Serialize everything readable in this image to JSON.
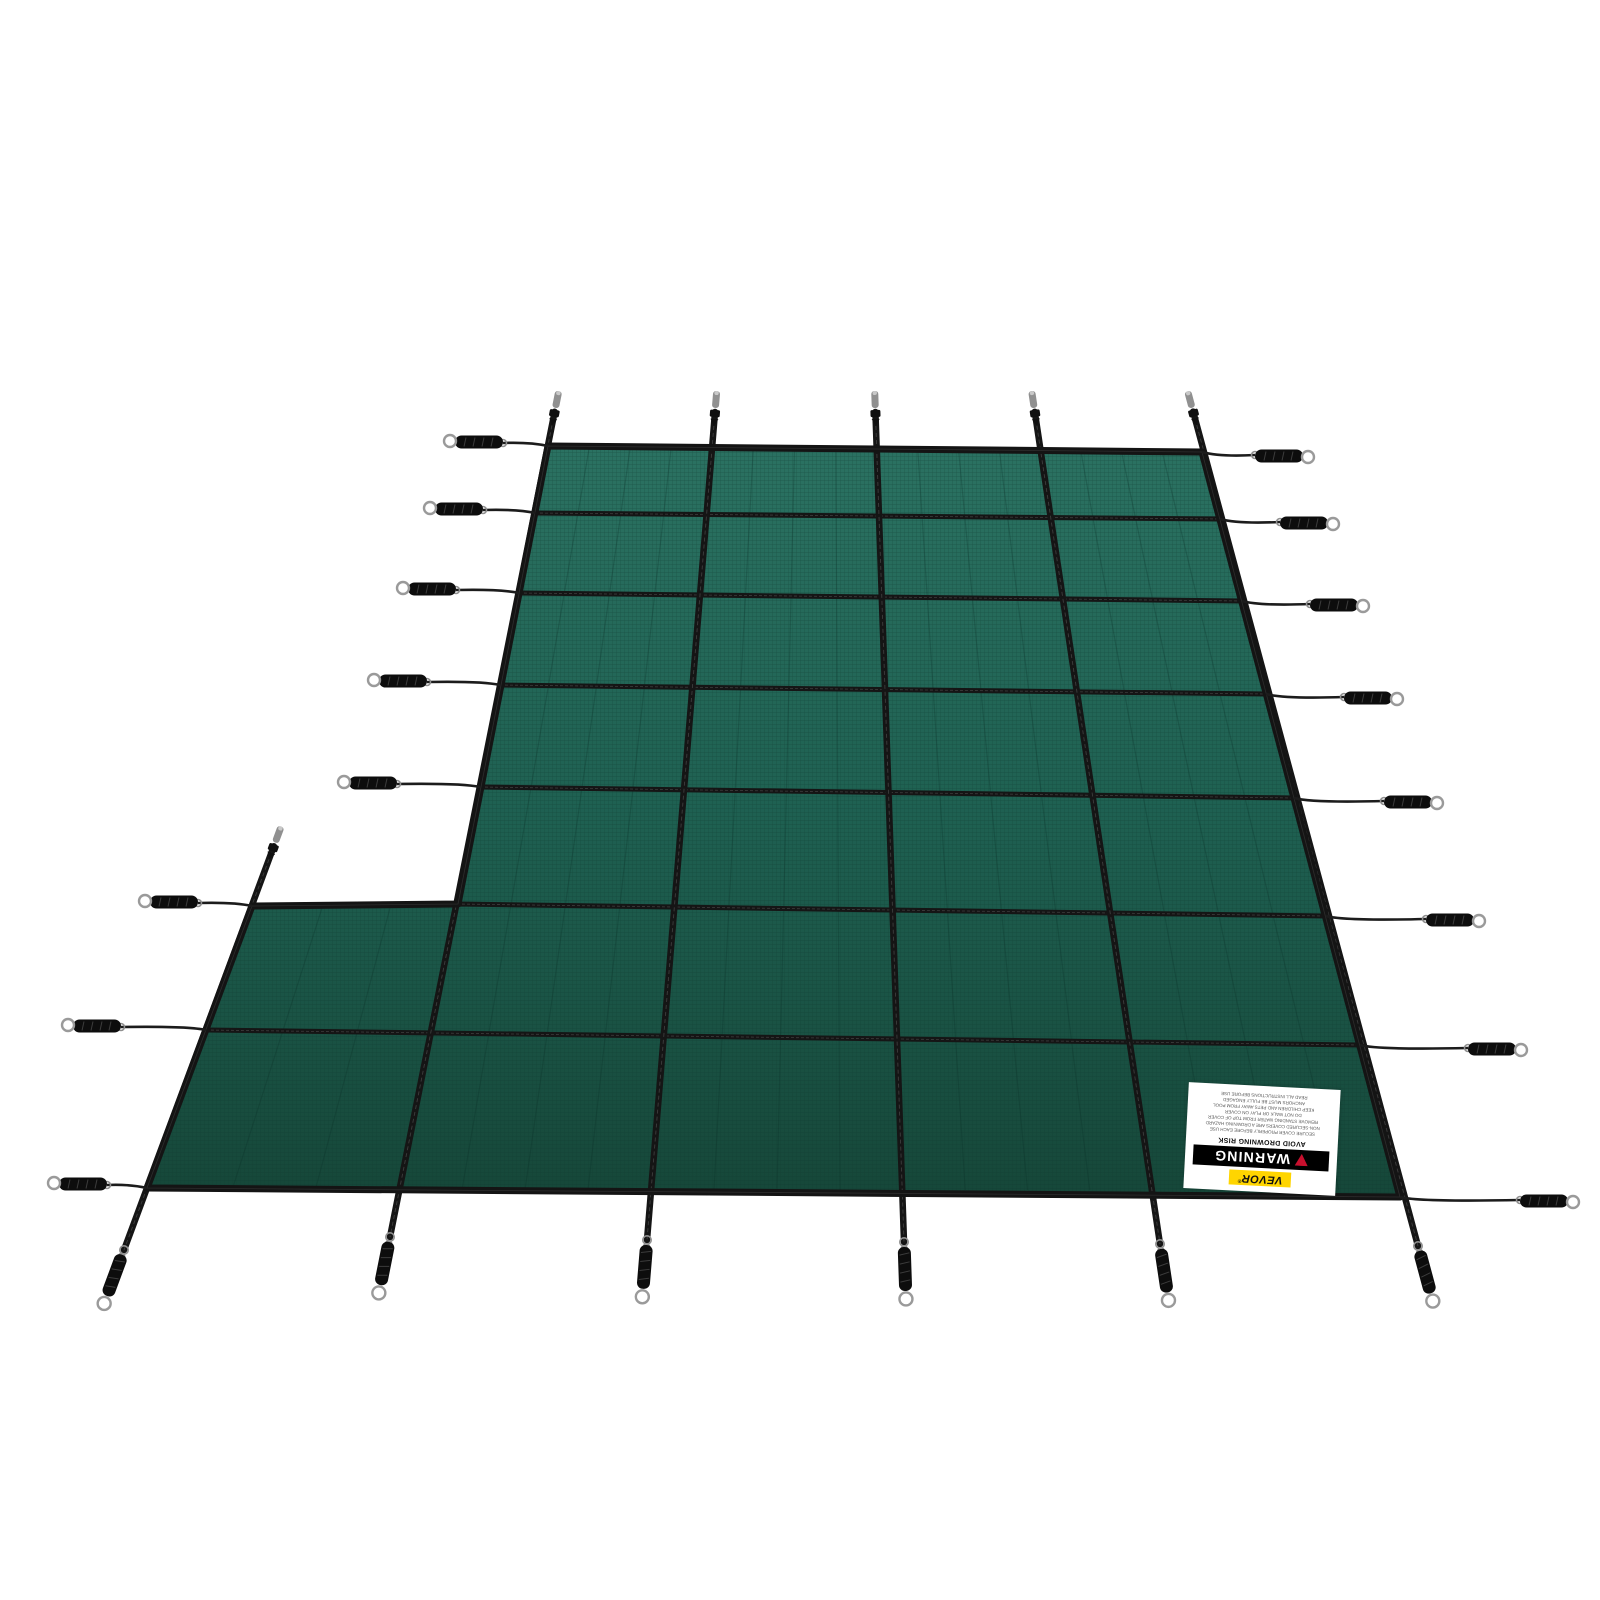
{
  "product": {
    "brand": "VEVOR",
    "name": "Inground Pool Safety Cover with Left Step Section"
  },
  "scene": {
    "background_color": "#ffffff",
    "cover": {
      "color_top": "#2b7262",
      "color_mid": "#1e6051",
      "color_bottom": "#164739",
      "mesh_line_color": "#0c352c",
      "seam_line_color": "#0a2e26",
      "edge_color": "#141414",
      "strap_color": "#151515",
      "strap_highlight": "#3d3d3d",
      "vertical_strap_count": 6,
      "horizontal_strap_count": 8,
      "shape": "rectangle-with-left-step"
    },
    "hardware": {
      "cable_color": "#1c1c1c",
      "spring_color": "#0d0d0d",
      "spring_hatch_color": "#3c3c3c",
      "loop_color": "#9a9a9a",
      "ring_color": "#8f8f8f",
      "anchor_pin_color": "#909090",
      "buckle_color": "#101010",
      "top_anchor_pin_count": 6,
      "bottom_anchor_count": 6,
      "left_spring_count": 8,
      "right_spring_count": 8
    }
  },
  "label": {
    "brand": "VEVOR",
    "brand_registered": "®",
    "brand_bg": "#ffd500",
    "warning_title": "WARNING",
    "warning_bg": "#000000",
    "warning_text_color": "#ffffff",
    "warning_icon_color": "#c8102e",
    "subtitle": "AVOID DROWNING RISK",
    "fine_print_lines": [
      "SECURE COVER PROPERLY BEFORE EACH USE",
      "NON-SECURED COVERS ARE A DROWNING HAZARD",
      "REMOVE STANDING WATER FROM TOP OF COVER",
      "DO NOT WALK OR PLAY ON COVER",
      "KEEP CHILDREN AND PETS AWAY FROM POOL",
      "ANCHORS MUST BE FULLY ENGAGED",
      "READ ALL INSTRUCTIONS BEFORE USE"
    ],
    "rotation_deg": 183
  }
}
